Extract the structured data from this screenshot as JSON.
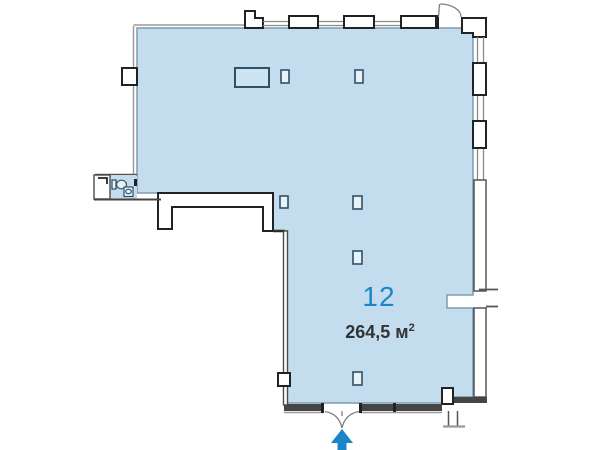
{
  "plan": {
    "unit_number": "12",
    "area_text": "264,5 м",
    "area_superscript": "2",
    "colors": {
      "floor_fill": "#c3ddee",
      "floor_edge": "#7b9cb0",
      "accent_blue": "#1b85c7",
      "wall_black": "#222222",
      "wall_gray": "#999999",
      "area_text_color": "#333333"
    }
  }
}
